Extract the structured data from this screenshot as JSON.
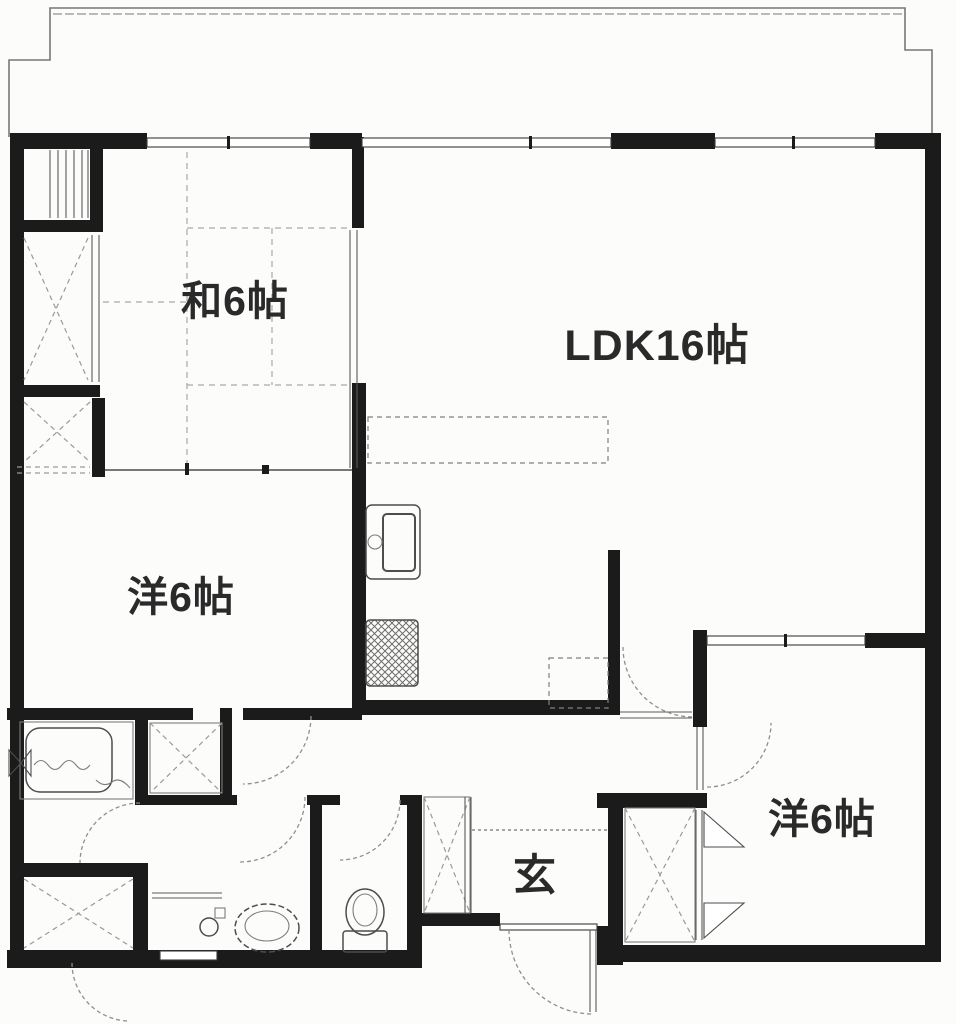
{
  "diagram_type": "apartment-floor-plan",
  "rooms": {
    "washitsu": {
      "label": "和6帖"
    },
    "ldk": {
      "label": "LDK16帖"
    },
    "western_left": {
      "label": "洋6帖"
    },
    "western_right": {
      "label": "洋6帖"
    },
    "genkan": {
      "label": "玄"
    }
  },
  "fixtures": [
    "bathtub",
    "bath-mixer",
    "kitchen-sink",
    "gas-stove",
    "kitchen-counter",
    "refrigerator-space",
    "washing-machine-space",
    "vanity-basin",
    "wash-bowl",
    "toilet",
    "tatami-grid",
    "futon-closet",
    "storage-closet",
    "shoe-storage",
    "trunk-room",
    "pipe-space"
  ],
  "colors": {
    "wall": "#1b1b1b",
    "thin_line": "#4d4d4d",
    "dash_line": "#8f8f8f",
    "background": "#fcfcfa"
  }
}
